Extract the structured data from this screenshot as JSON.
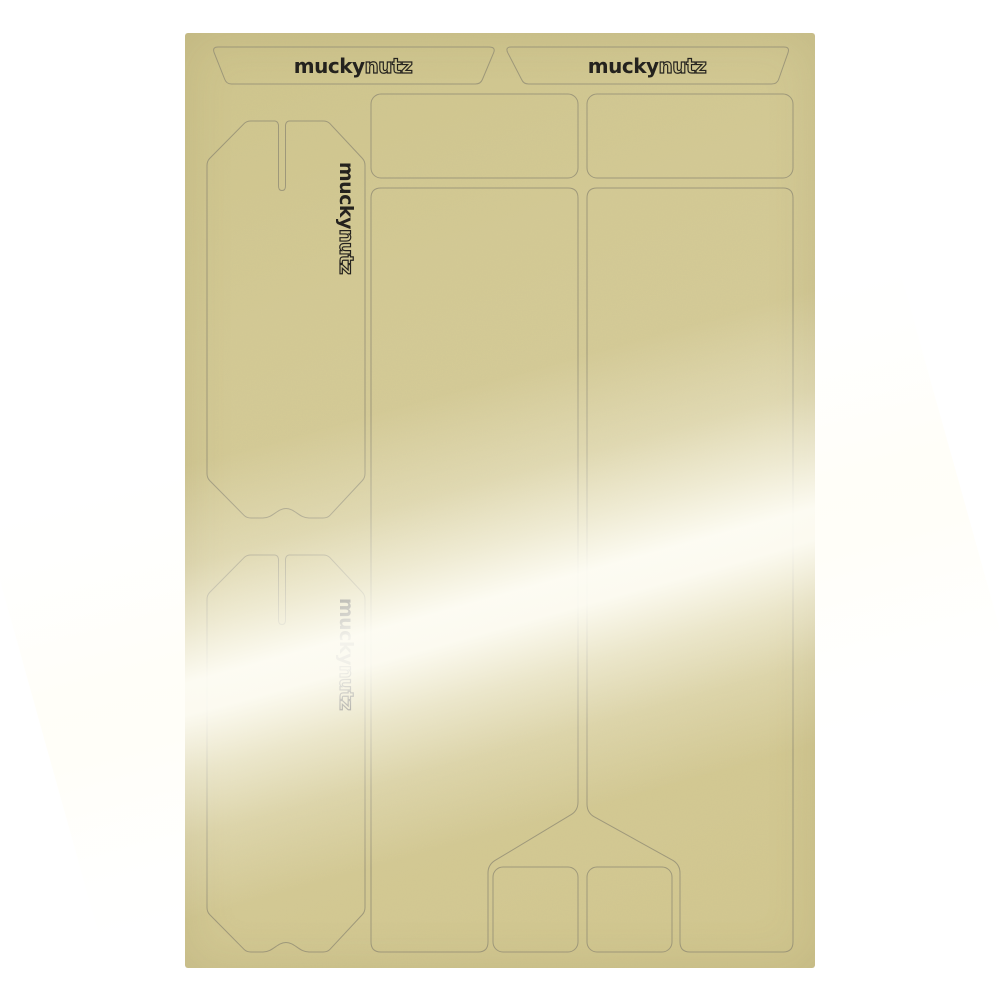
{
  "brand": {
    "primary": "mucky",
    "secondary": "nutz"
  },
  "colors": {
    "background": "#ffffff",
    "sheet": "#d4ca94",
    "sheet_dark": "#cfc48a",
    "cutline": "#8e8972",
    "logo": "#1d1b18",
    "glare": "#fffef6"
  }
}
